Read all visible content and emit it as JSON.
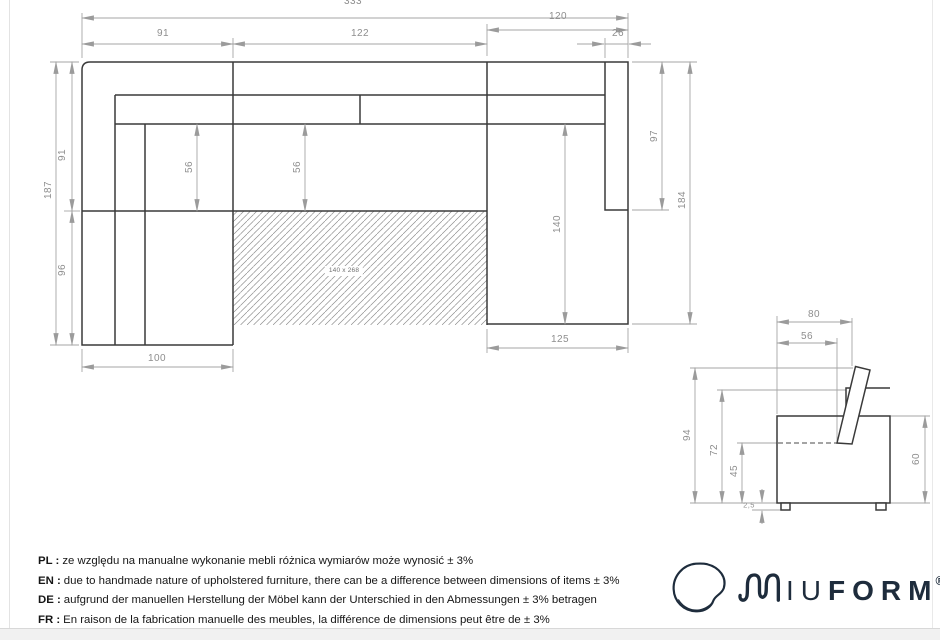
{
  "top_view": {
    "total_width": "333",
    "left_width": "91",
    "middle_width": "122",
    "right_width": "120",
    "armrest_width": "26",
    "total_depth": "187",
    "upper_depth": "91",
    "lower_depth": "96",
    "seat_depth_left": "56",
    "seat_depth_middle": "56",
    "chaise_length": "140",
    "armrest_length": "97",
    "right_depth": "184",
    "left_chaise_width": "100",
    "right_chaise_width": "125",
    "sleeping_area": "140 x 268"
  },
  "side_view": {
    "depth": "80",
    "seat_depth": "56",
    "total_height": "94",
    "backrest_height": "72",
    "seat_height": "45",
    "leg_height": "2,5",
    "arm_height": "60"
  },
  "disclaimer": {
    "items": [
      {
        "lang": "PL :",
        "text": "ze względu na manualne wykonanie mebli różnica wymiarów może wynosić ± 3%"
      },
      {
        "lang": "EN :",
        "text": "due to handmade nature of upholstered furniture, there can be a difference between dimensions of items ± 3%"
      },
      {
        "lang": "DE :",
        "text": "aufgrund der manuellen Herstellung der Möbel kann der Unterschied in den Abmessungen ± 3% betragen"
      },
      {
        "lang": "FR :",
        "text": "En raison de la fabrication manuelle des meubles, la différence de dimensions peut être de ± 3%"
      }
    ]
  },
  "logo": {
    "name_regular": "IU",
    "name_bold": "FORM",
    "registered": "®"
  },
  "colors": {
    "drawing_line": "#3a3a3a",
    "dimension_line": "#a6a6a6",
    "dimension_text": "#8e8e8e",
    "logo_navy": "#1e2c3c"
  }
}
